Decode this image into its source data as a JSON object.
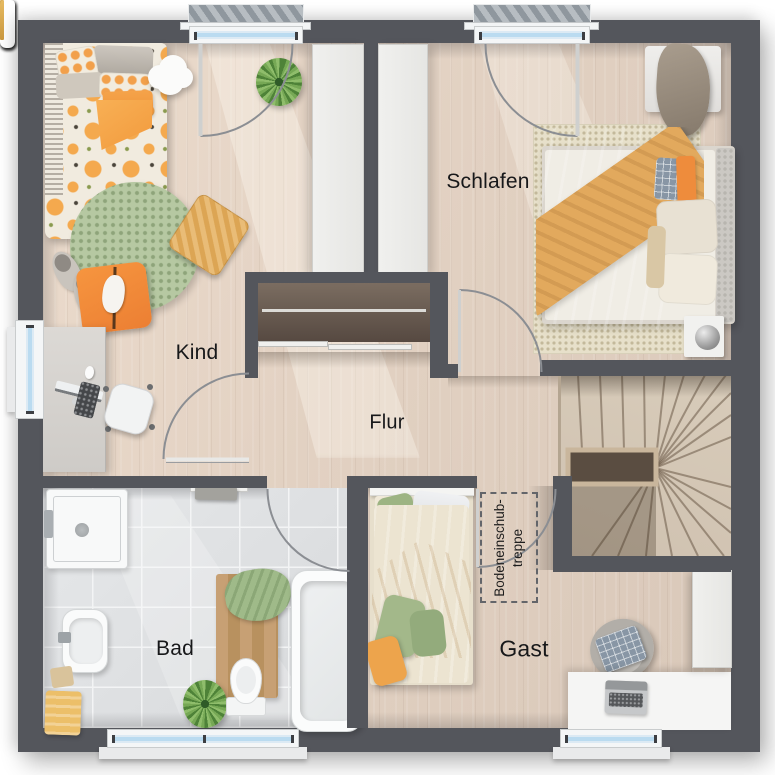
{
  "floorplan": {
    "rooms": [
      {
        "id": "kind",
        "label": "Kind"
      },
      {
        "id": "schlafen",
        "label": "Schlafen"
      },
      {
        "id": "flur",
        "label": "Flur"
      },
      {
        "id": "bad",
        "label": "Bad"
      },
      {
        "id": "gast",
        "label": "Gast"
      }
    ],
    "annotation": {
      "line1": "Bodeneinschub-",
      "line2": "treppe"
    },
    "colors": {
      "wall": "#54565c",
      "wood_floor": "#e2d2c3",
      "tile_floor": "#dfe1e3",
      "stair_wood": "#cfc1b0",
      "closet_interior": "#675a50",
      "accent_orange": "#f3a04a",
      "accent_green": "#a9c392",
      "window_glass": "#badbf0",
      "rug_green": "#b6c8a2"
    }
  }
}
